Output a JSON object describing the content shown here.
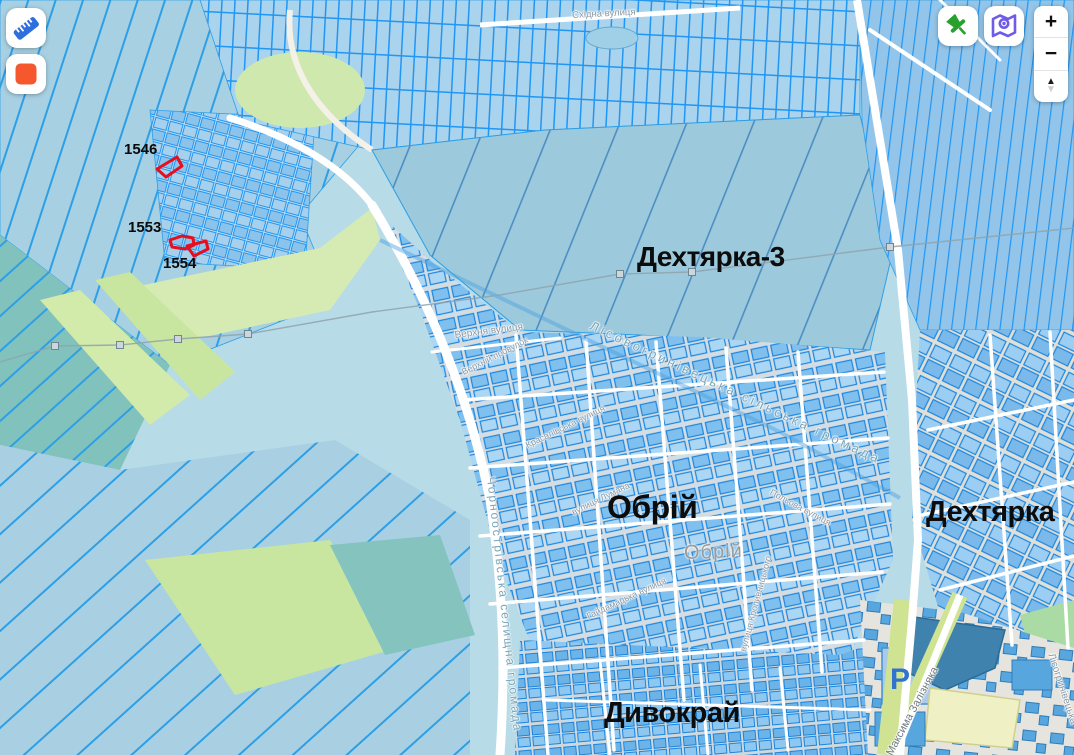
{
  "controls": {
    "measure": {
      "icon": "ruler-icon"
    },
    "stop": {
      "icon": "stop-square-icon"
    },
    "marker": {
      "icon": "green-pushpin-icon"
    },
    "map_style": {
      "icon": "purple-map-pin-icon"
    },
    "zoom_in": "+",
    "zoom_out": "−",
    "tilt_up": "▲",
    "tilt_down": "▼"
  },
  "parcels": [
    {
      "number": "1546"
    },
    {
      "number": "1553"
    },
    {
      "number": "1554"
    }
  ],
  "towns": [
    "Дехтярка-3",
    "Обрій",
    "Дехтярка",
    "Дивокрай"
  ],
  "streets": [
    "Східна вулиця",
    "Верхня вулиця",
    "Верхній провулок",
    "Красалівська вулиця",
    "вулиця Лумана",
    "Гайдамацька вулиця",
    "Польова вулиця",
    "вулиця Кропивницького",
    "Максима Залізняка",
    "Лісогринівецька"
  ],
  "boundaries": [
    "Лісовогринівецька сільська громада",
    "Чорноострівська селищна громада"
  ],
  "misc_labels": {
    "settlement_gray": "Обрій",
    "parking": "P"
  },
  "colors": {
    "parcel_stroke": "#2196f3",
    "highlight_red": "#e60f1e",
    "accent_orange": "#f4582c",
    "accent_green": "#27a12c",
    "accent_purple": "#6f5be8",
    "map_background": "#b7dbe7"
  }
}
